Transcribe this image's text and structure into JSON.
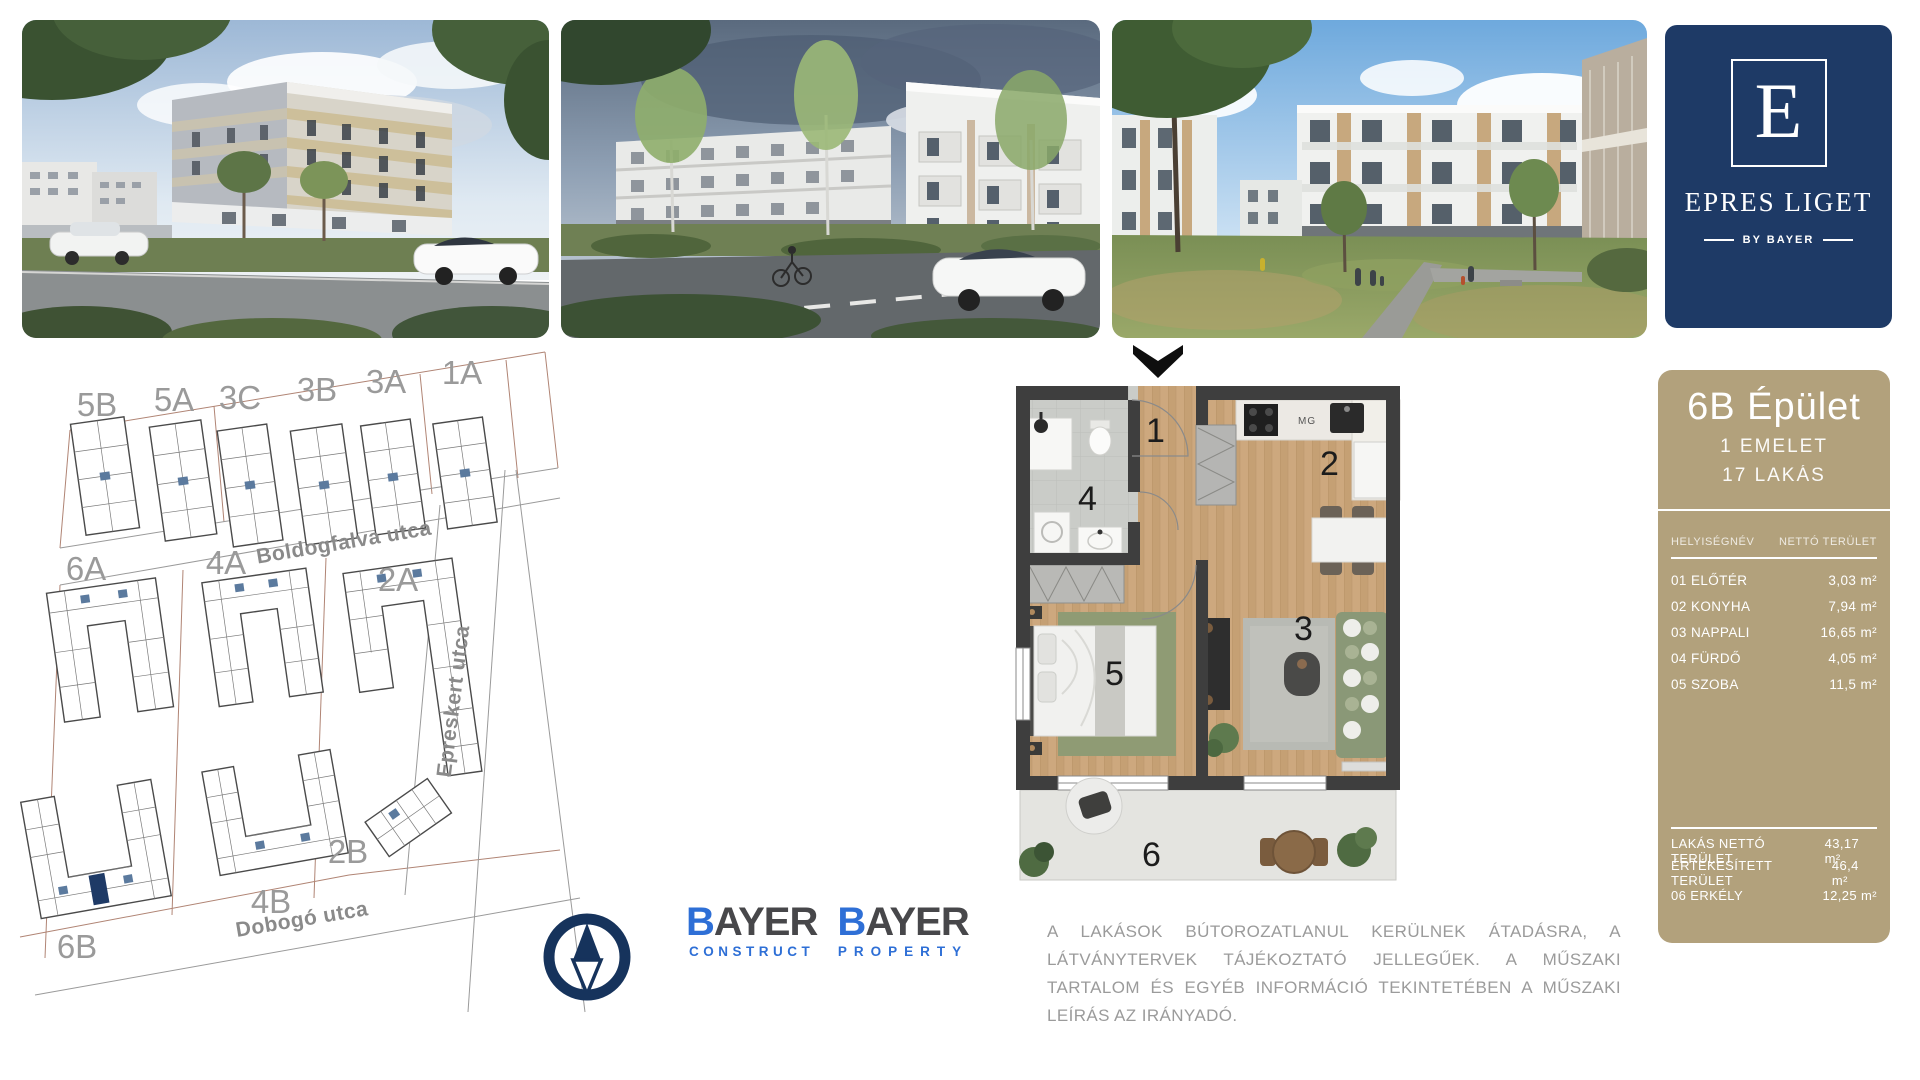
{
  "logo_panel": {
    "letter": "E",
    "title": "EPRES LIGET",
    "byline": "BY BAYER",
    "bg_color": "#1e3a66"
  },
  "site_map": {
    "buildings": [
      {
        "label": "5B"
      },
      {
        "label": "5A"
      },
      {
        "label": "3C"
      },
      {
        "label": "3B"
      },
      {
        "label": "3A"
      },
      {
        "label": "1A"
      },
      {
        "label": "6A"
      },
      {
        "label": "4A"
      },
      {
        "label": "2A"
      },
      {
        "label": "6B"
      },
      {
        "label": "4B"
      },
      {
        "label": "2B"
      }
    ],
    "streets": [
      {
        "name": "Boldogfalva utca"
      },
      {
        "name": "Epreskert utca"
      },
      {
        "name": "Dobogó utca"
      }
    ],
    "highlight_color": "#1e3a66"
  },
  "floor_plan": {
    "rooms": [
      {
        "n": "1"
      },
      {
        "n": "2"
      },
      {
        "n": "3"
      },
      {
        "n": "4"
      },
      {
        "n": "5"
      },
      {
        "n": "6"
      }
    ],
    "kitchen_label": "MG"
  },
  "info_panel": {
    "title": "6B Épület",
    "subtitle1": "1 EMELET",
    "subtitle2": "17 LAKÁS",
    "bg_color": "#b2a17c",
    "table": {
      "col_name": "HELYISÉGNÉV",
      "col_area": "NETTÓ TERÜLET",
      "rows": [
        {
          "name": "01 ELŐTÉR",
          "value": "3,03 m²"
        },
        {
          "name": "02 KONYHA",
          "value": "7,94 m²"
        },
        {
          "name": "03 NAPPALI",
          "value": "16,65 m²"
        },
        {
          "name": "04 FÜRDŐ",
          "value": "4,05 m²"
        },
        {
          "name": "05 SZOBA",
          "value": "11,5 m²"
        }
      ],
      "summary": [
        {
          "name": "LAKÁS NETTÓ TERÜLET",
          "value": "43,17 m²"
        },
        {
          "name": "ÉRTÉKESÍTETT TERÜLET",
          "value": "46,4 m²"
        },
        {
          "name": "06 ERKÉLY",
          "value": "12,25 m²"
        }
      ]
    }
  },
  "logos": {
    "construct": {
      "b": "B",
      "rest": "AYER",
      "sub": "CONSTRUCT"
    },
    "property": {
      "b": "B",
      "rest": "AYER",
      "sub": "PROPERTY"
    },
    "blue": "#2e6fd6",
    "dark": "#47474a"
  },
  "disclaimer": {
    "text": "A LAKÁSOK BÚTOROZATLANUL KERÜLNEK ÁTADÁSRA, A LÁTVÁNYTERVEK TÁJÉKOZTATÓ JELLEGŰEK. A MŰSZAKI TARTALOM ÉS EGYÉB INFORMÁCIÓ TEKINTETÉBEN A MŰSZAKI LEÍRÁS AZ IRÁNYADÓ."
  }
}
